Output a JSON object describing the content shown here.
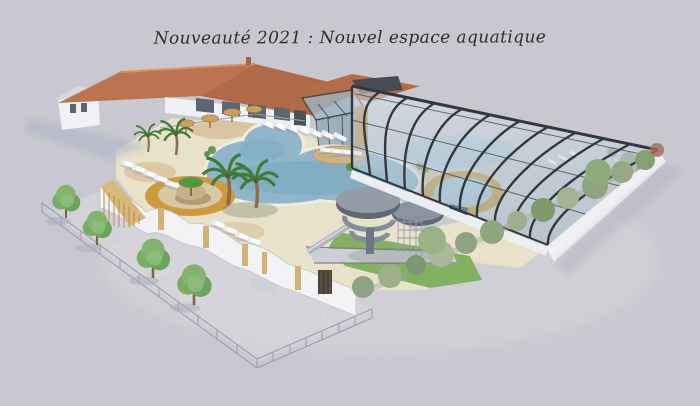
{
  "title": {
    "text": "Nouveauté 2021 : Nouvel espace aquatique"
  },
  "palette": {
    "background": "#c9c8d1",
    "deck": "#e8e2cb",
    "sand": "#d9c29b",
    "ochre_ring": "#cf9a3e",
    "pool_water": "#8fb6ca",
    "pool_water_deep": "#6f9fba",
    "roof_terracotta": "#bd7350",
    "building_white": "#eef0f3",
    "enclosure_frame": "#33383d",
    "enclosure_glass": "#b9cdd9",
    "grass": "#83b061",
    "tree_green": "#76a865",
    "hedge_green": "#8fa383",
    "wood_tan": "#c9a05c",
    "slide_gray": "#7c8591",
    "wall_white": "#f3f2f4",
    "parasol_green": "#4d9b40",
    "shadow_blue": "#a9b1c6"
  },
  "scene": {
    "type": "3D architectural rendering",
    "subject": "aquatic park with lagoon pool, spiral waterslides, glass pool enclosure, sun loungers, palm trees and landscaping"
  }
}
